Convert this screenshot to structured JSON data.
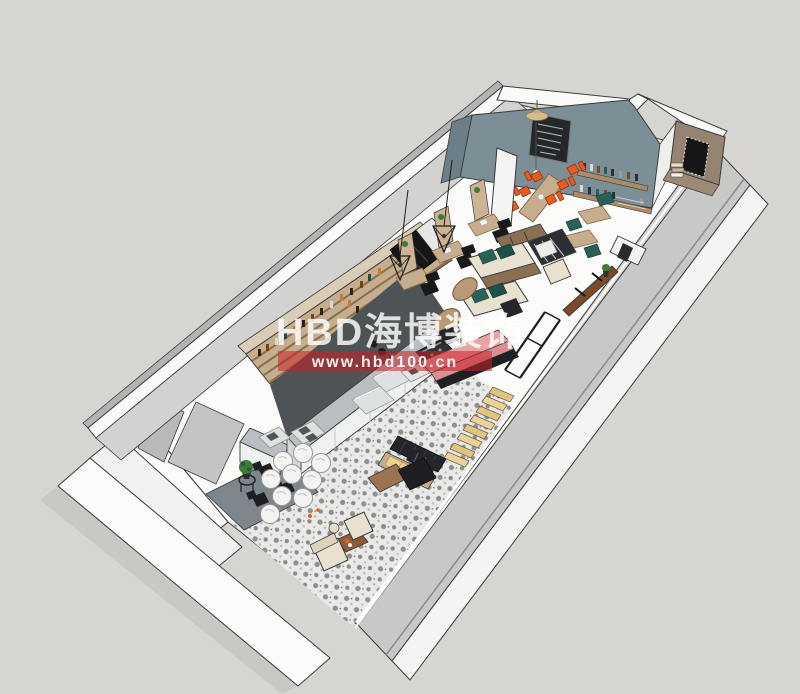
{
  "watermark": {
    "brand": "HBD海博装饰",
    "url": "www.hbd100.cn"
  },
  "palette": {
    "bg": "#d6d5d1",
    "wallWhite": "#fafaf9",
    "wallFace": "#c8c8c6",
    "wallFaceDark": "#b3b3b1",
    "wallInner": "#d2d2d0",
    "ink": "#3a3a38",
    "floor": "#fbfbfa",
    "slate": "#7c8e96",
    "slateDark": "#6c7e87",
    "chalk": "#25282a",
    "brownWall": "#958471",
    "wood": "#c5ad8e",
    "woodDark": "#a98b68",
    "woodRed": "#8a5c3a",
    "counterSteel": "#b9bfc0",
    "counterFront": "#eff0f0",
    "steelLight": "#dde1e1",
    "aisle": "#4e5356",
    "dark": "#1f1f22",
    "orange": "#e85a1e",
    "teal": "#2a6157",
    "cream": "#e9e1cf",
    "yellow": "#edd092",
    "pink": "#e8a3a5",
    "tileBase": "#e9e9e7",
    "tileMotif": "#8f8f8d",
    "floorGray": "#7d868c",
    "plant": "#3e7a39",
    "wmRed": "#c92027",
    "wmText": "#ffffff"
  }
}
